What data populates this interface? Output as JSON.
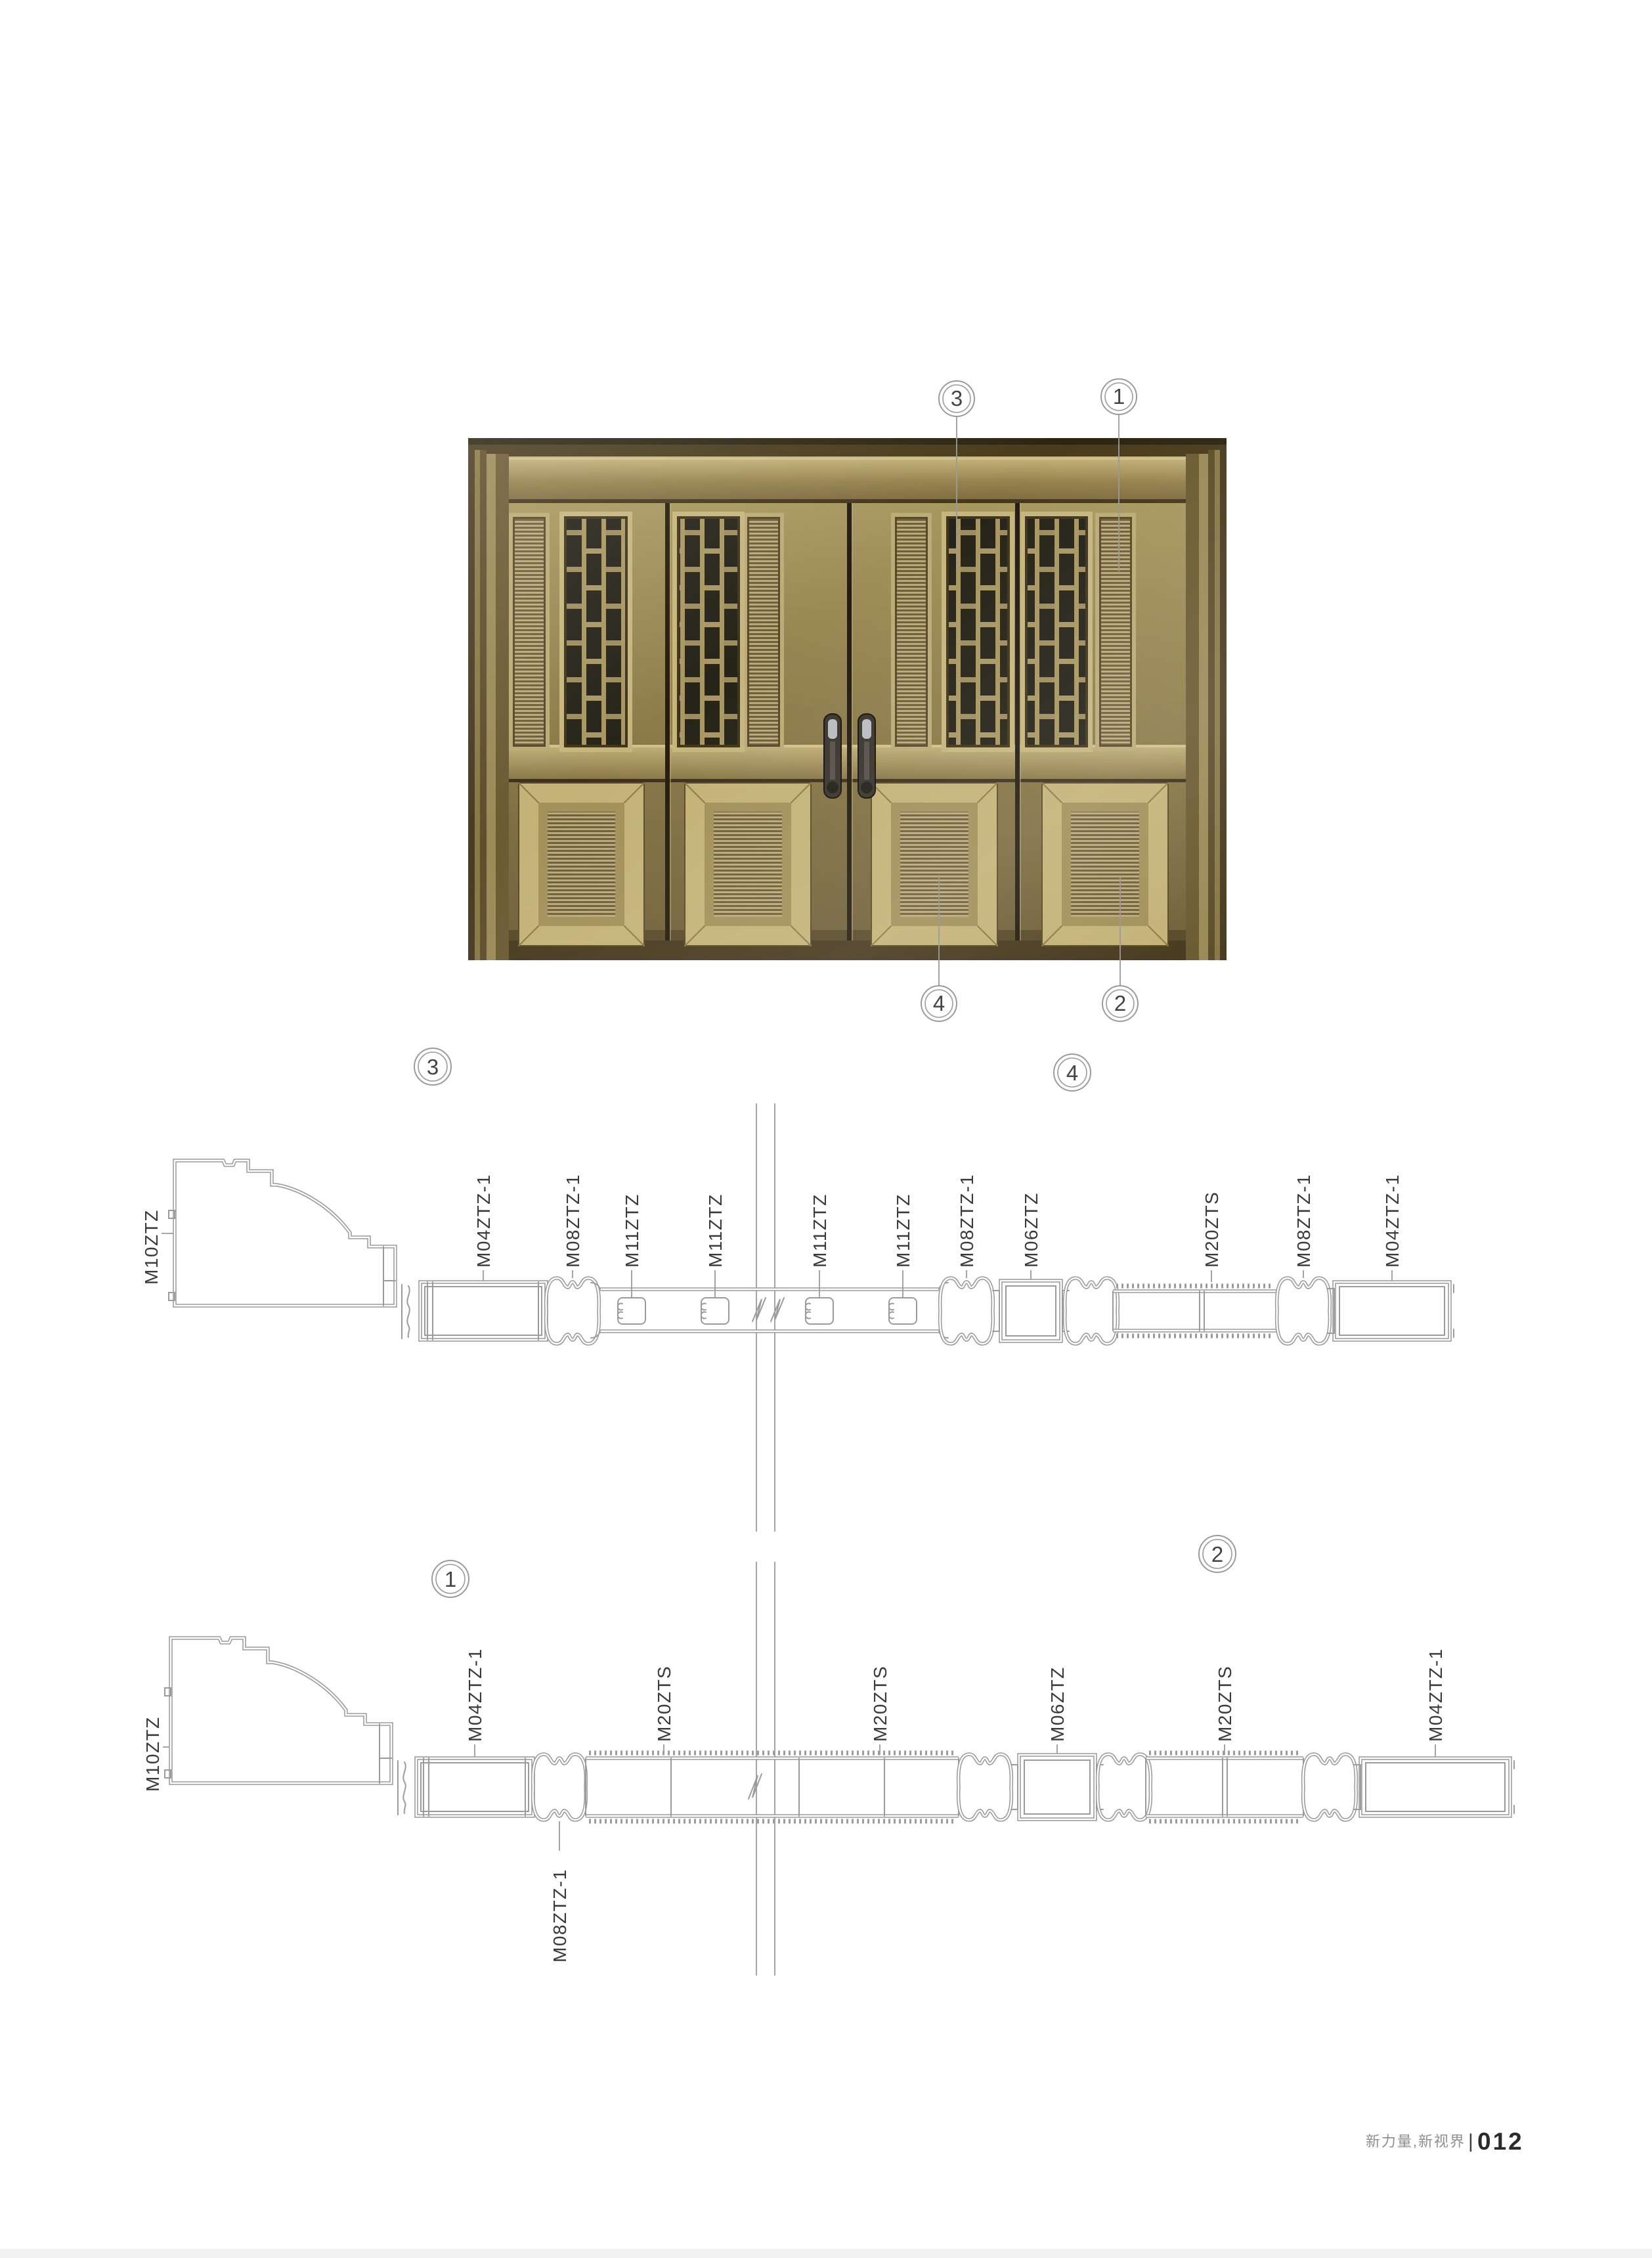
{
  "page": {
    "brand": "新力量,新视界",
    "divider": "|",
    "number": "012"
  },
  "callouts": {
    "n1": "1",
    "n2": "2",
    "n3": "3",
    "n4": "4"
  },
  "sections": {
    "top": {
      "callout_left": "3",
      "callout_right": "4",
      "jamb": "M10ZTZ",
      "labels": [
        "M04ZTZ-1",
        "M08ZTZ-1",
        "M11ZTZ",
        "M11ZTZ",
        "M11ZTZ",
        "M11ZTZ",
        "M08ZTZ-1",
        "M06ZTZ",
        "M20ZTS",
        "M08ZTZ-1",
        "M04ZTZ-1"
      ]
    },
    "bottom": {
      "callout_left": "1",
      "callout_right": "2",
      "jamb": "M10ZTZ",
      "labels": [
        "M04ZTZ-1",
        "M20ZTS",
        "M20ZTS",
        "M06ZTZ",
        "M20ZTS",
        "M04ZTZ-1"
      ],
      "below_label": "M08ZTZ-1"
    }
  },
  "colors": {
    "cad_line": "#9b9b9b",
    "label_text": "#3a3a3a",
    "door_brass": "#a6925d",
    "door_frame_dark": "#3c311b",
    "door_glass": "#26241a",
    "footer_gray": "#8f8f8f",
    "footer_number": "#2b2b2b"
  }
}
